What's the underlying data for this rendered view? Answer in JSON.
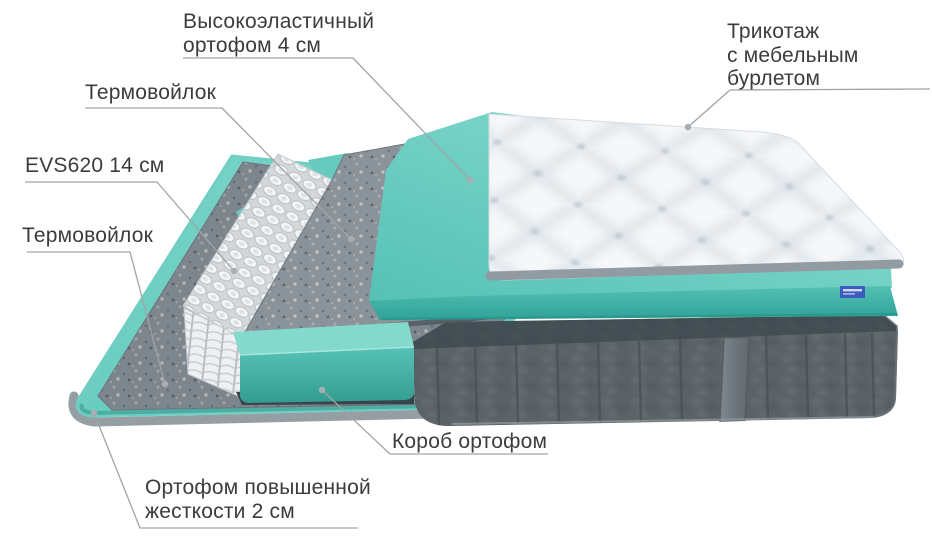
{
  "diagram": {
    "type": "mattress-exploded-layers",
    "labels": {
      "top_foam": "Высокоэластичный\nортофом 4 см",
      "cover": "Трикотаж\nс мебельным\nбурлетом",
      "felt_top": "Термовойлок",
      "springs": "EVS620 14 см",
      "felt_bottom": "Термовойлок",
      "box_foam": "Короб ортофом",
      "base_foam": "Ортофом повышенной\nжесткости 2 см"
    },
    "colors": {
      "foam_teal": "#6fcfc3",
      "foam_teal_dark": "#45b0a5",
      "felt_gray": "#858d94",
      "spring_white": "#f2f4f6",
      "base_dark": "#5a6266",
      "cover_white": "#f4f6f8",
      "label_text": "#3b3c3e",
      "leader_line": "#a0a4a7",
      "tag_blue": "#3d5ac0"
    }
  }
}
